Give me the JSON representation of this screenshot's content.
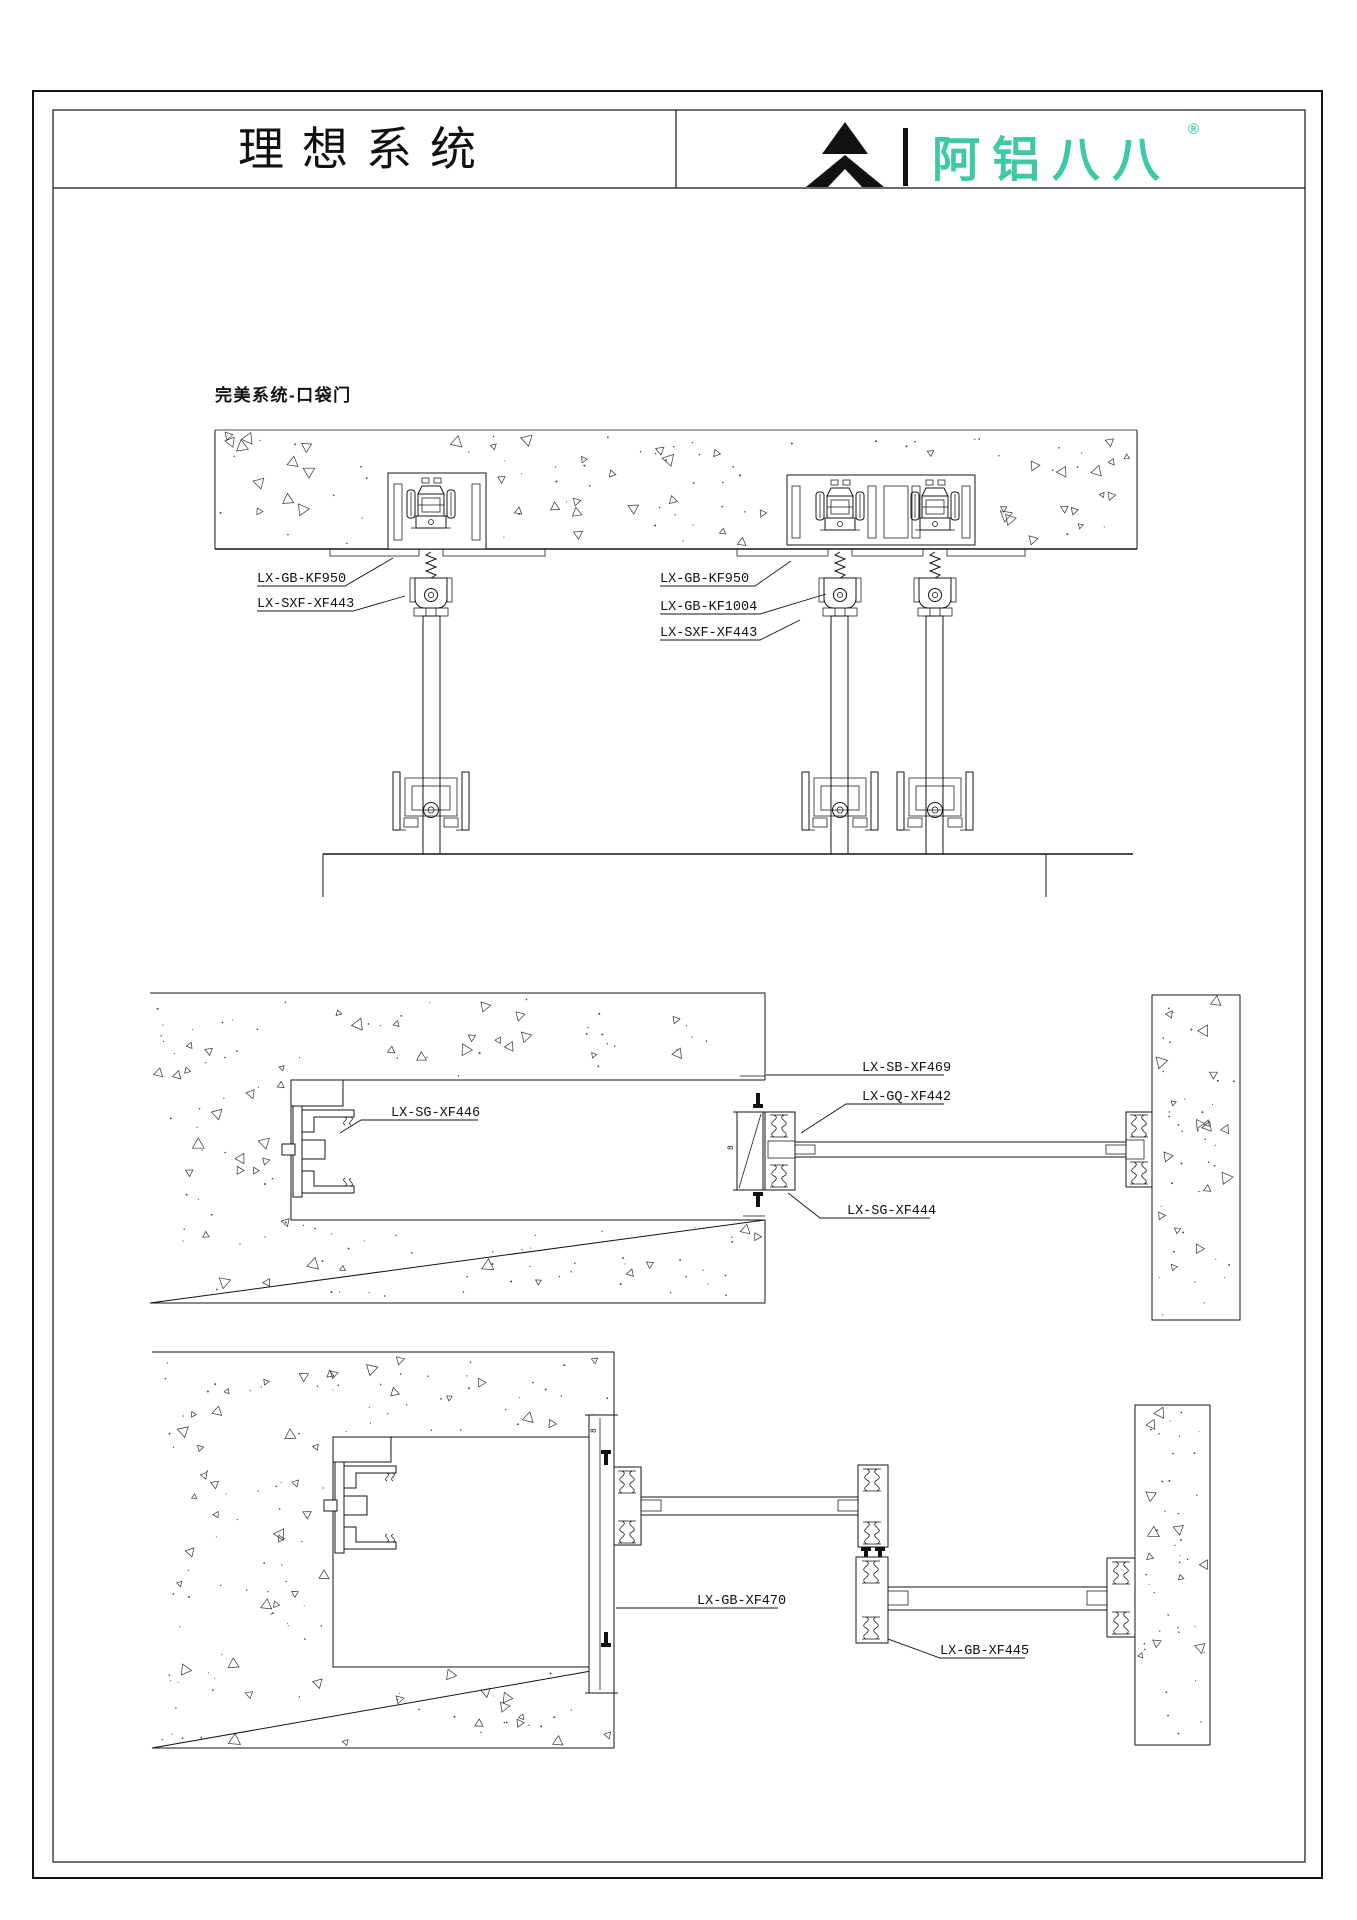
{
  "header": {
    "title": "理想系统",
    "logo_text": "阿铝八八",
    "registered": "®"
  },
  "section": {
    "heading": "完美系统-口袋门"
  },
  "labels": {
    "top": [
      "LX-GB-KF950",
      "LX-SXF-XF443",
      "LX-GB-KF950",
      "LX-GB-KF1004",
      "LX-SXF-XF443"
    ],
    "middle": [
      "LX-SB-XF469",
      "LX-GQ-XF442",
      "LX-SG-XF446",
      "LX-SG-XF444"
    ],
    "bottom": [
      "LX-GB-XF470",
      "LX-GB-XF445"
    ]
  },
  "marks": {
    "weld_a": "8",
    "weld_b": "8"
  },
  "colors": {
    "brand_teal": "#3DC9A6",
    "line": "#141414"
  }
}
